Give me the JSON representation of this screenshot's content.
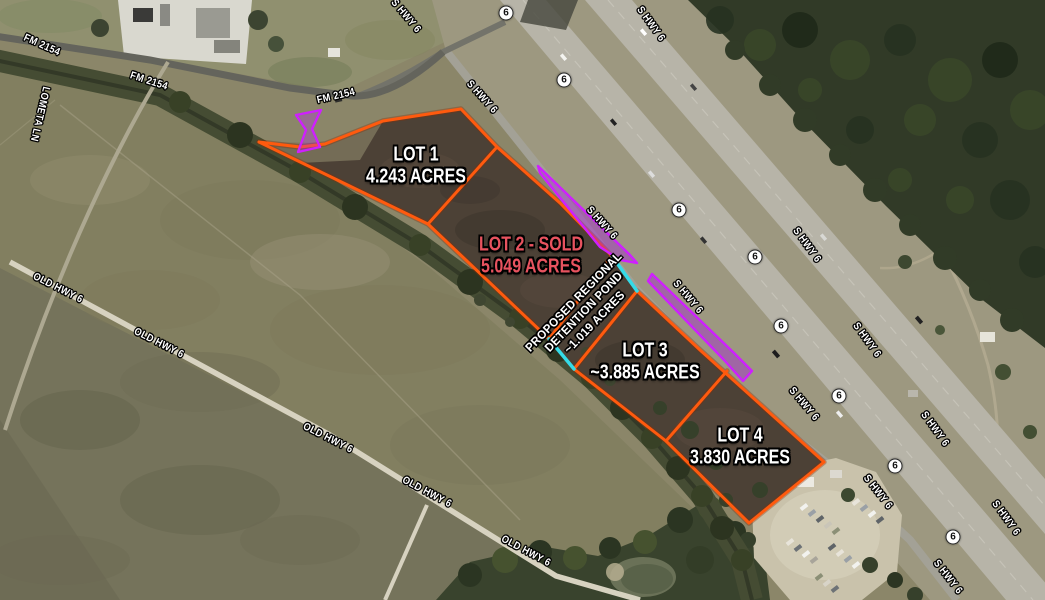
{
  "map": {
    "description": "Aerial commercial land lot map at FM 2154 and S HWY 6",
    "colors": {
      "lot_boundary": "#ff5a0e",
      "pond_edge": "#35dbe8",
      "access_marking": "#cf1fff",
      "sold_text": "#e8535f",
      "label_text": "#ffffff"
    },
    "lots": [
      {
        "name": "LOT 1",
        "acreage": "4.243 ACRES",
        "x": 416,
        "y": 166,
        "sold": false
      },
      {
        "name": "LOT 2 - SOLD",
        "acreage": "5.049 ACRES",
        "x": 531,
        "y": 256,
        "sold": true
      },
      {
        "name": "LOT 3",
        "acreage": "~3.885 ACRES",
        "x": 645,
        "y": 362,
        "sold": false
      },
      {
        "name": "LOT 4",
        "acreage": "3.830 ACRES",
        "x": 740,
        "y": 447,
        "sold": false
      }
    ],
    "detention_pond": {
      "lines": [
        "PROPOSED REGIONAL",
        "DETENTION POND",
        "~1.019 ACRES"
      ],
      "x": 584,
      "y": 312,
      "rotation": -46
    },
    "road_labels": [
      {
        "text": "FM 2154",
        "x": 42,
        "y": 45,
        "rotation": 24
      },
      {
        "text": "FM 2154",
        "x": 149,
        "y": 81,
        "rotation": 18
      },
      {
        "text": "FM 2154",
        "x": 336,
        "y": 96,
        "rotation": -13
      },
      {
        "text": "LOMETA LN",
        "x": 40,
        "y": 114,
        "rotation": 103
      },
      {
        "text": "S HWY 6",
        "x": 406,
        "y": 16,
        "rotation": 50
      },
      {
        "text": "S HWY 6",
        "x": 482,
        "y": 97,
        "rotation": 48
      },
      {
        "text": "S HWY 6",
        "x": 651,
        "y": 24,
        "rotation": 54
      },
      {
        "text": "S HWY 6",
        "x": 602,
        "y": 223,
        "rotation": 48
      },
      {
        "text": "S HWY 6",
        "x": 688,
        "y": 297,
        "rotation": 50
      },
      {
        "text": "S HWY 6",
        "x": 807,
        "y": 245,
        "rotation": 54
      },
      {
        "text": "S HWY 6",
        "x": 867,
        "y": 340,
        "rotation": 54
      },
      {
        "text": "S HWY 6",
        "x": 804,
        "y": 404,
        "rotation": 50
      },
      {
        "text": "S HWY 6",
        "x": 935,
        "y": 429,
        "rotation": 54
      },
      {
        "text": "S HWY 6",
        "x": 878,
        "y": 492,
        "rotation": 52
      },
      {
        "text": "S HWY 6",
        "x": 1006,
        "y": 518,
        "rotation": 54
      },
      {
        "text": "S HWY 6",
        "x": 948,
        "y": 577,
        "rotation": 52
      },
      {
        "text": "OLD HWY 6",
        "x": 58,
        "y": 288,
        "rotation": 27
      },
      {
        "text": "OLD HWY 6",
        "x": 159,
        "y": 343,
        "rotation": 27
      },
      {
        "text": "OLD HWY 6",
        "x": 328,
        "y": 438,
        "rotation": 27
      },
      {
        "text": "OLD HWY 6",
        "x": 427,
        "y": 492,
        "rotation": 28
      },
      {
        "text": "OLD HWY 6",
        "x": 526,
        "y": 551,
        "rotation": 28
      }
    ],
    "highway_shields": [
      {
        "text": "6",
        "x": 506,
        "y": 13
      },
      {
        "text": "6",
        "x": 564,
        "y": 80
      },
      {
        "text": "6",
        "x": 679,
        "y": 210
      },
      {
        "text": "6",
        "x": 755,
        "y": 257
      },
      {
        "text": "6",
        "x": 781,
        "y": 326
      },
      {
        "text": "6",
        "x": 839,
        "y": 396
      },
      {
        "text": "6",
        "x": 895,
        "y": 466
      },
      {
        "text": "6",
        "x": 953,
        "y": 537
      }
    ]
  }
}
